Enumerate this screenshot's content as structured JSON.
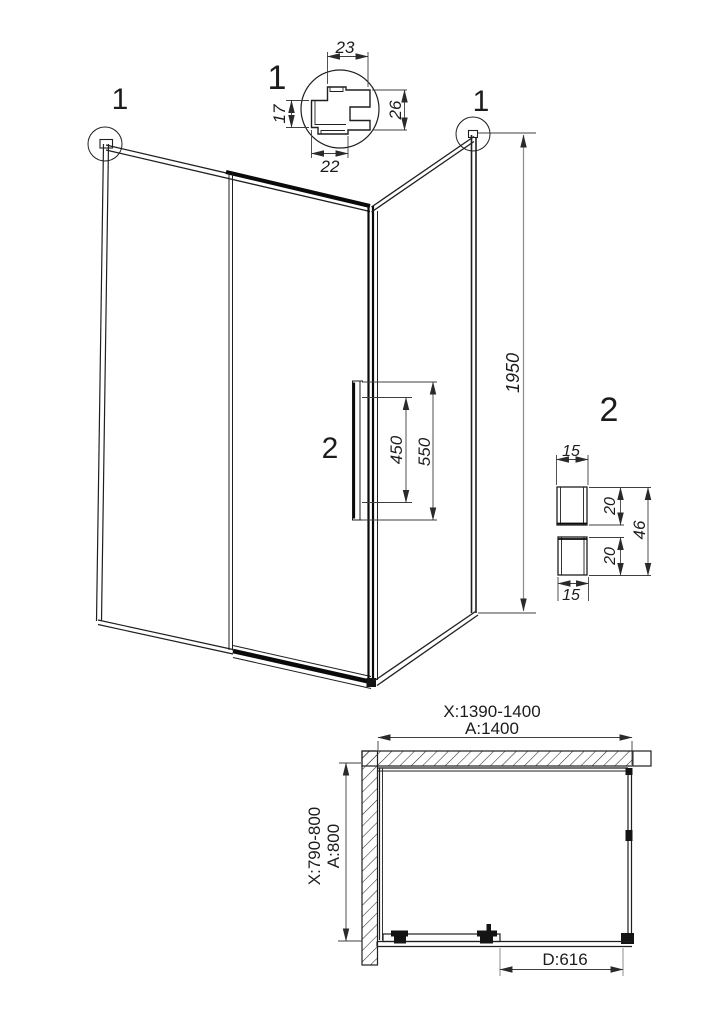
{
  "drawing_title": "shower-enclosure-technical-drawing",
  "colors": {
    "line": "#1f1f1f",
    "thick_line": "#0a0a0a",
    "dimension": "#3f3f3f",
    "dimension_gray": "#8c8c8c",
    "background": "#ffffff"
  },
  "elevation": {
    "corner_left_ref": "1",
    "corner_right_ref": "1",
    "height_dim": "1950",
    "handle_ref": "2",
    "handle_inner_dim": "450",
    "handle_outer_dim": "550"
  },
  "detail_profile": {
    "ref": "1",
    "dim_top": "23",
    "dim_left": "17",
    "dim_right": "26",
    "dim_bottom": "22"
  },
  "detail_handle": {
    "ref": "2",
    "dim_top_width": "15",
    "dim_upper_depth": "20",
    "dim_total_height": "46",
    "dim_lower_depth": "20",
    "dim_bottom_width": "15"
  },
  "plan": {
    "width_adjust": "X:1390-1400",
    "width_nominal": "A:1400",
    "depth_adjust": "X:790-800",
    "depth_nominal": "A:800",
    "door_dim": "D:616"
  }
}
